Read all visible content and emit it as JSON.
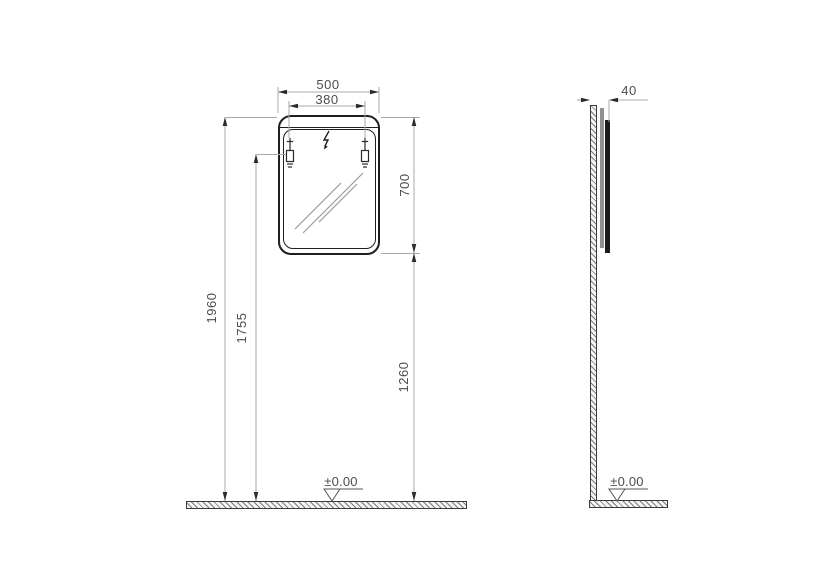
{
  "front_view": {
    "overall_width": "500",
    "mounting_width": "380",
    "mirror_height": "700",
    "overall_height": "1960",
    "mounting_height": "1755",
    "underside_height": "1260",
    "floor_datum": "±0.00"
  },
  "side_view": {
    "depth": "40",
    "floor_datum": "±0.00"
  },
  "colors": {
    "object_line": "#1f1f1f",
    "dimension_line": "#aaaaaa",
    "arrow": "#2b2b2b",
    "text": "#4d4d4d",
    "hatch_fill": "#f4f4f4"
  }
}
